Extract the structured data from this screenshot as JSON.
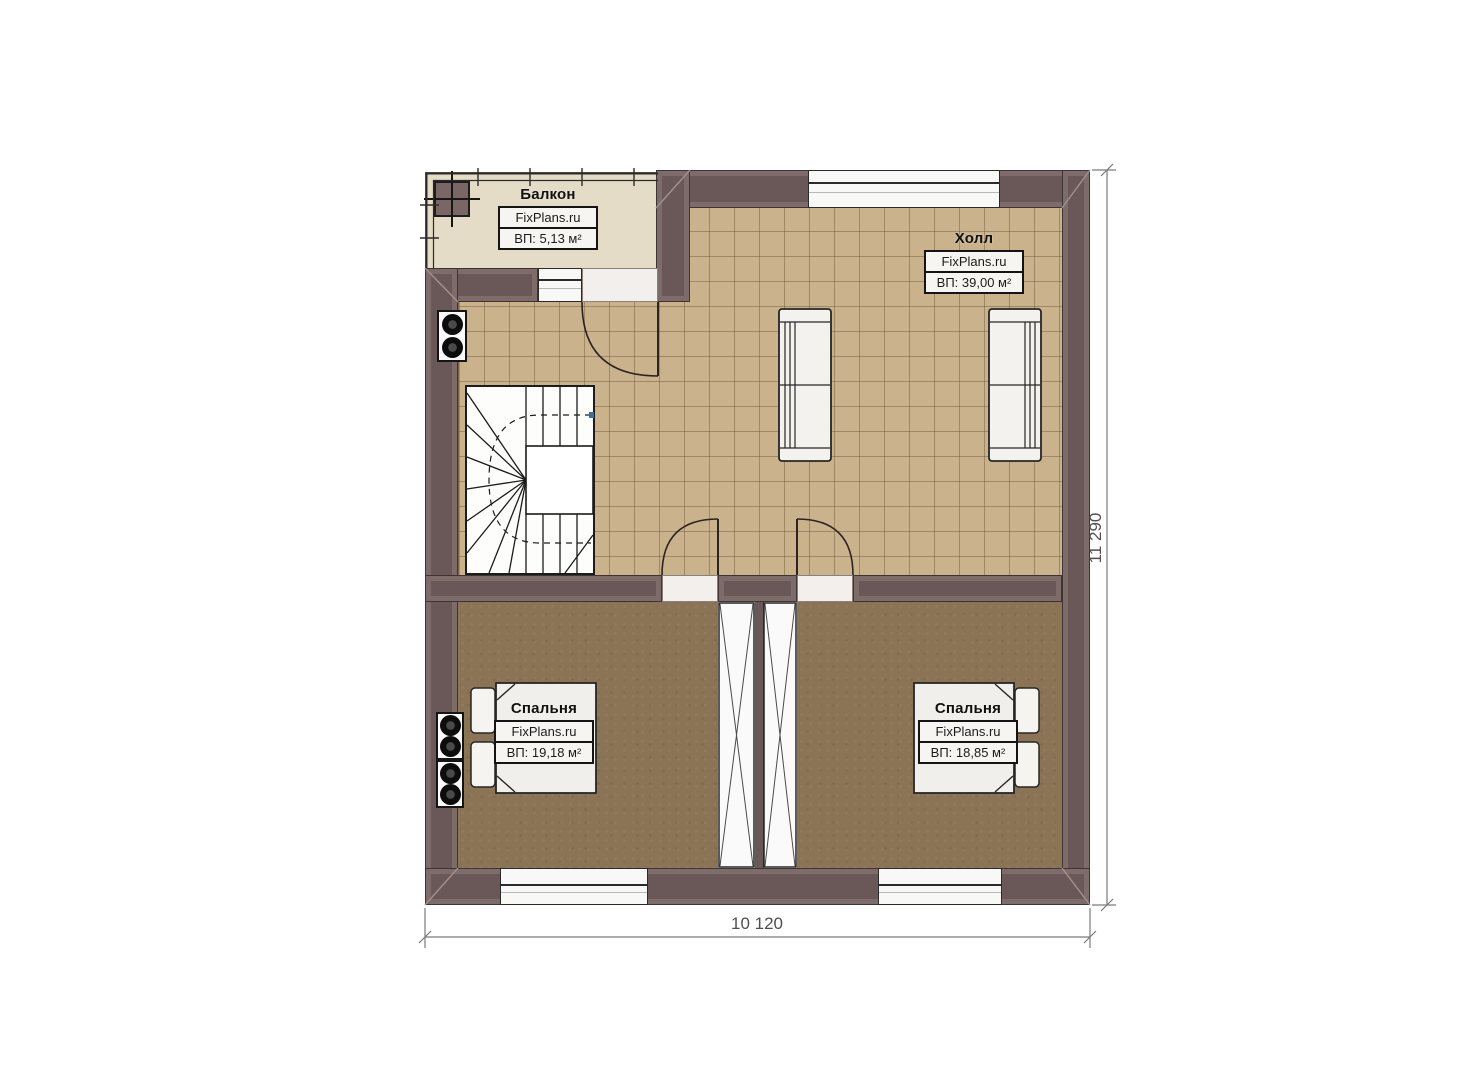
{
  "rooms": {
    "balcony": {
      "name": "Балкон",
      "brand": "FixPlans.ru",
      "area": "ВП: 5,13 м²"
    },
    "hall": {
      "name": "Холл",
      "brand": "FixPlans.ru",
      "area": "ВП: 39,00 м²"
    },
    "bedroom_left": {
      "name": "Спальня",
      "brand": "FixPlans.ru",
      "area": "ВП: 19,18 м²"
    },
    "bedroom_right": {
      "name": "Спальня",
      "brand": "FixPlans.ru",
      "area": "ВП: 18,85 м²"
    }
  },
  "dimensions": {
    "bottom": "10 120",
    "right": "11 290"
  },
  "colors": {
    "wall": "#6a5758",
    "wall_band": "#7e6c6a",
    "hall_floor": "#c9b28c",
    "bedroom_floor": "#8b7356",
    "balcony_floor": "#e5dcc7",
    "dimension_text": "#4f4f4f"
  }
}
